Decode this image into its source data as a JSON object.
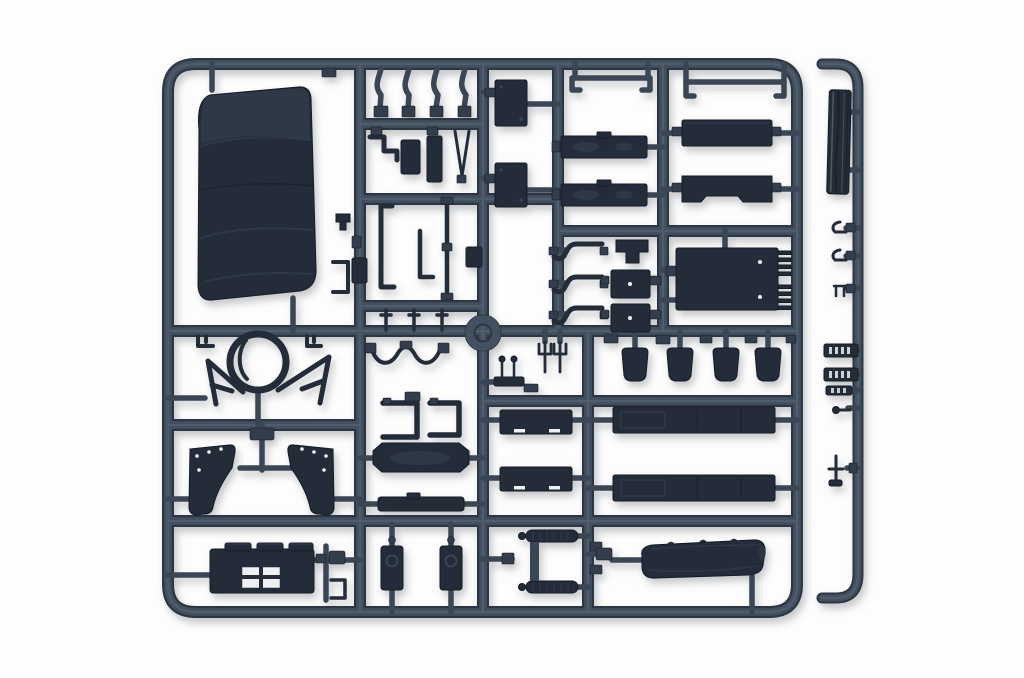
{
  "scene": {
    "kind": "product-photo",
    "subject": "plastic model kit sprue",
    "description": "Dark blue-grey injection-moulded sprue (runner frame) of truck model parts photographed on a white background, with a large canvas tilt cover, panels, fenders, rails and a separate thin detail runner strip on the right",
    "background": "#fdfdfd"
  },
  "colors": {
    "bg": "#fdfdfd",
    "runner": "#43505f",
    "runner_hi": "#5d6b7a",
    "runner_dark": "#2d3743",
    "stem": "#3a4654",
    "part": "#232c38",
    "part_hi": "#3a4453",
    "part_edge": "#151c26",
    "pad": "#333d4b",
    "white_mark": "#eef0f2",
    "plank_dark": "#1e2227",
    "plank_light": "#60646a"
  },
  "parts": [
    {
      "id": "canvas-tilt-cover",
      "label": "large canvas tilt cover"
    },
    {
      "id": "bent-lever-arms",
      "label": "four bent lever arms"
    },
    {
      "id": "door-panels",
      "label": "two small door panels"
    },
    {
      "id": "side-boards",
      "label": "two sideboard planks"
    },
    {
      "id": "stake-rails",
      "label": "stake rails with hooked ends"
    },
    {
      "id": "bed-panels",
      "label": "flat bed panels"
    },
    {
      "id": "tailgate-hinged-panel",
      "label": "hinged tailgate panel"
    },
    {
      "id": "steering-wheel-ring",
      "label": "steering wheel ring"
    },
    {
      "id": "mirror-arms",
      "label": "mirror support arms"
    },
    {
      "id": "fenders",
      "label": "mirrored fender pair"
    },
    {
      "id": "cab-rear-window-panel",
      "label": "cab rear panel with window"
    },
    {
      "id": "bed-floor-panel",
      "label": "bed floor panel"
    },
    {
      "id": "seat-backs",
      "label": "two seat back panels"
    },
    {
      "id": "window-frames",
      "label": "two window frames"
    },
    {
      "id": "wiring-loom",
      "label": "wavy wiring loom"
    },
    {
      "id": "step-hooks",
      "label": "three step hooks"
    },
    {
      "id": "mud-flap-squares",
      "label": "square mud flaps"
    },
    {
      "id": "fender-flaps",
      "label": "four fender flaps"
    },
    {
      "id": "trident-forks",
      "label": "two fork pieces"
    },
    {
      "id": "mirror-stalks",
      "label": "two mirror stalks"
    },
    {
      "id": "hinge-panels",
      "label": "gate panels with hinge marks"
    },
    {
      "id": "chassis-rails",
      "label": "two long chassis rails"
    },
    {
      "id": "leaf-spring-assembly",
      "label": "leaf spring assembly"
    },
    {
      "id": "rolled-tarpaulin",
      "label": "rolled tarpaulin"
    },
    {
      "id": "exhaust-plank",
      "label": "textured plank piece"
    },
    {
      "id": "grab-hooks",
      "label": "small grab hooks"
    },
    {
      "id": "track-links",
      "label": "small toothed links"
    },
    {
      "id": "shift-lever",
      "label": "shift lever"
    },
    {
      "id": "injection-gate-ring",
      "label": "central gate ring"
    },
    {
      "id": "sprue-frame",
      "label": "main runner frame"
    },
    {
      "id": "detail-runner-strip",
      "label": "separate right runner strip"
    }
  ]
}
